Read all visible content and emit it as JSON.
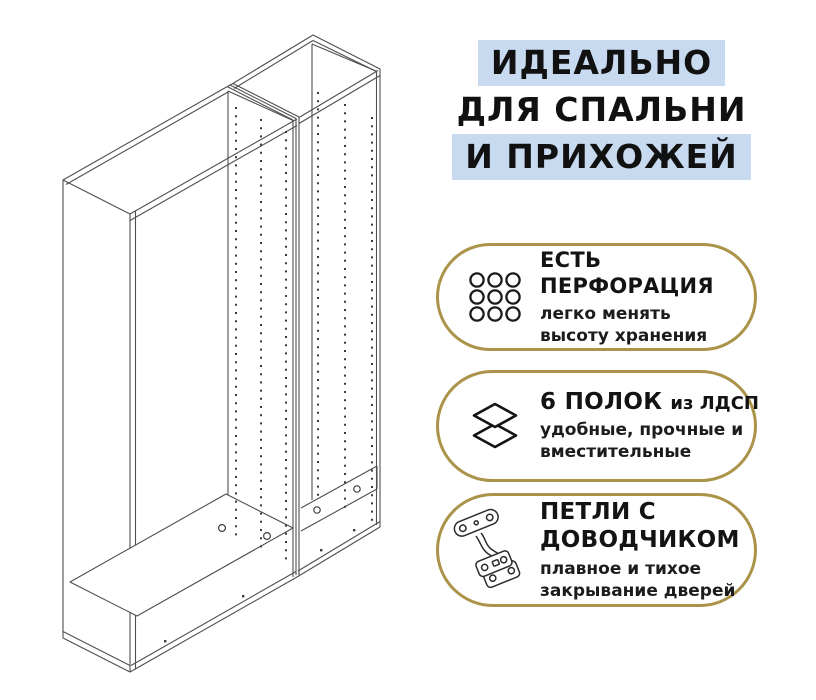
{
  "page": {
    "background": "#ffffff"
  },
  "illustration": {
    "name": "two-wardrobe-frames-isometric-line-drawing"
  },
  "headline": {
    "highlight_color": "#c7daf0",
    "lines": [
      {
        "text": "ИДЕАЛЬНО",
        "highlighted": true
      },
      {
        "text": "ДЛЯ СПАЛЬНИ",
        "highlighted": false
      },
      {
        "text": "И ПРИХОЖЕЙ",
        "highlighted": true
      }
    ]
  },
  "features": {
    "border_color": "#ab9349",
    "items": [
      {
        "icon": "perforation-grid-icon",
        "title_line1": "ЕСТЬ",
        "title_line2": "ПЕРФОРАЦИЯ",
        "subtitle_line1": "легко менять",
        "subtitle_line2": "высоту хранения"
      },
      {
        "icon": "shelves-layers-icon",
        "title_main": "6 ПОЛОК",
        "title_suffix": "из ЛДСП",
        "subtitle_line1": "удобные, прочные и",
        "subtitle_line2": "вместительные"
      },
      {
        "icon": "door-hinge-icon",
        "title_line1": "ПЕТЛИ С",
        "title_line2": "ДОВОДЧИКОМ",
        "subtitle_line1": "плавное и тихое",
        "subtitle_line2": "закрывание дверей"
      }
    ]
  }
}
